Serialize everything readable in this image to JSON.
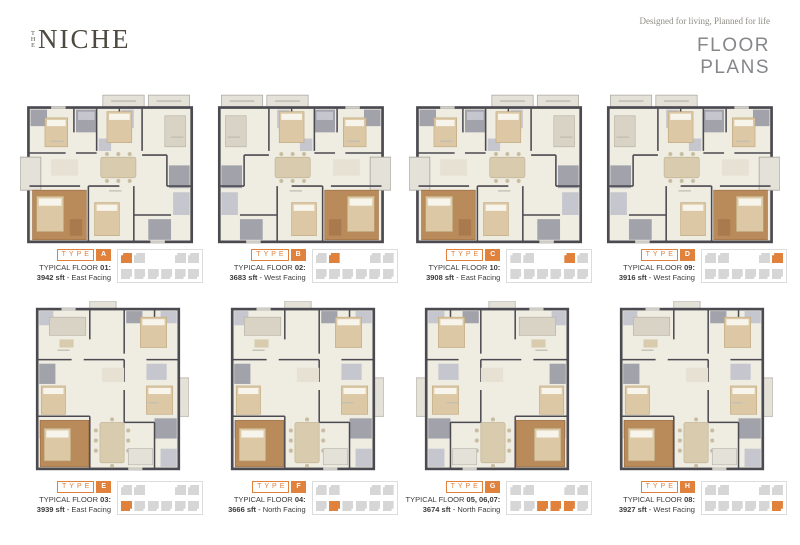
{
  "brand": {
    "the": "THE",
    "name": "NICHE"
  },
  "header": {
    "tagline": "Designed for living, Planned for life",
    "heading_line1": "FLOOR",
    "heading_line2": "PLANS"
  },
  "colors": {
    "accent_orange": "#E0813C",
    "key_gray": "#D6D6D6",
    "wall_dark": "#4B4A51",
    "floor_cream": "#EFECE2",
    "wet_area_gray": "#A2A2AB",
    "wood_brown": "#B98B5B",
    "heading_gray": "#85878B"
  },
  "plans": [
    {
      "type_label": "TYPE",
      "type_letter": "A",
      "floor_text": "TYPICAL FLOOR",
      "floor_num": "01:",
      "area": "3942 sft",
      "facing": "- East Facing",
      "variant": "landscape",
      "mirrored": false,
      "key": {
        "row": "top",
        "indices": [
          0
        ]
      }
    },
    {
      "type_label": "TYPE",
      "type_letter": "B",
      "floor_text": "TYPICAL FLOOR",
      "floor_num": "02:",
      "area": "3683 sft",
      "facing": "- West Facing",
      "variant": "landscape",
      "mirrored": true,
      "key": {
        "row": "top",
        "indices": [
          1
        ]
      }
    },
    {
      "type_label": "TYPE",
      "type_letter": "C",
      "floor_text": "TYPICAL FLOOR",
      "floor_num": "10:",
      "area": "3908 sft",
      "facing": "- East Facing",
      "variant": "landscape",
      "mirrored": false,
      "key": {
        "row": "top",
        "indices": [
          2
        ]
      }
    },
    {
      "type_label": "TYPE",
      "type_letter": "D",
      "floor_text": "TYPICAL FLOOR",
      "floor_num": "09:",
      "area": "3916 sft",
      "facing": "- West Facing",
      "variant": "landscape",
      "mirrored": true,
      "key": {
        "row": "top",
        "indices": [
          3
        ]
      }
    },
    {
      "type_label": "TYPE",
      "type_letter": "E",
      "floor_text": "TYPICAL FLOOR",
      "floor_num": "03:",
      "area": "3939 sft",
      "facing": "- East Facing",
      "variant": "portrait",
      "mirrored": false,
      "key": {
        "row": "bottom",
        "indices": [
          0
        ]
      }
    },
    {
      "type_label": "TYPE",
      "type_letter": "F",
      "floor_text": "TYPICAL FLOOR",
      "floor_num": "04:",
      "area": "3666 sft",
      "facing": "- North Facing",
      "variant": "portrait",
      "mirrored": false,
      "key": {
        "row": "bottom",
        "indices": [
          1
        ]
      }
    },
    {
      "type_label": "TYPE",
      "type_letter": "G",
      "floor_text": "TYPICAL FLOOR",
      "floor_num": "05, 06,07:",
      "area": "3674 sft",
      "facing": "- North Facing",
      "variant": "portrait",
      "mirrored": true,
      "key": {
        "row": "bottom",
        "indices": [
          2,
          3,
          4
        ]
      }
    },
    {
      "type_label": "TYPE",
      "type_letter": "H",
      "floor_text": "TYPICAL FLOOR",
      "floor_num": "08:",
      "area": "3927 sft",
      "facing": "- West Facing",
      "variant": "portrait",
      "mirrored": false,
      "key": {
        "row": "bottom",
        "indices": [
          5
        ]
      }
    }
  ]
}
